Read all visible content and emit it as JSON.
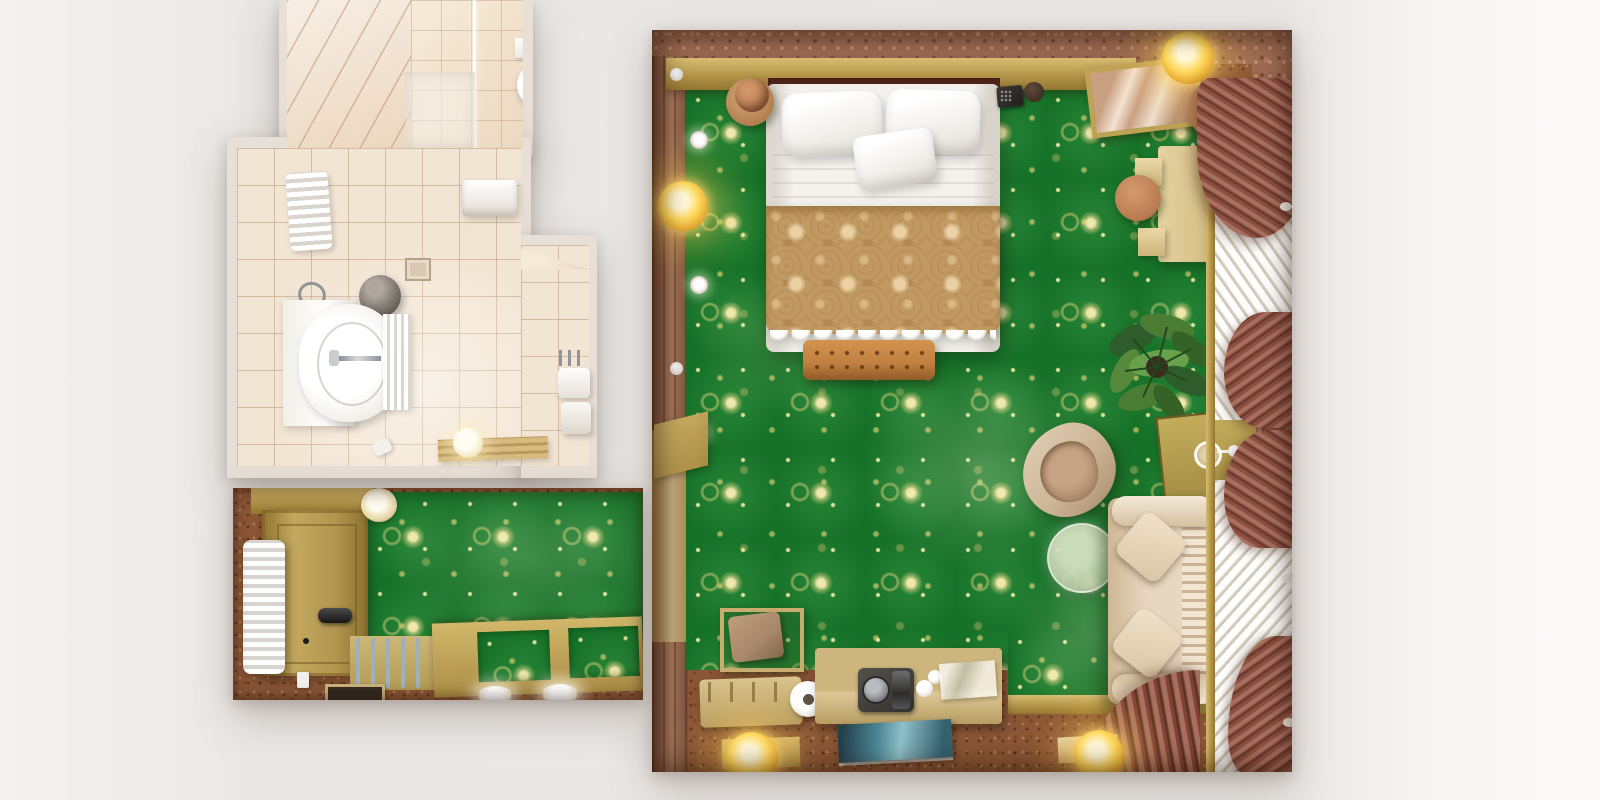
{
  "scene": {
    "type": "top-down 3d architectural render",
    "description": "Overhead render of a hotel suite: en-suite bathroom top-left, entry hallway bottom-left, and a large bedroom on the right with green-and-gold damask carpet, double bed, sofa, desk, plant and curtained windows."
  },
  "colors": {
    "background": "#e9e7e5",
    "carpet_green": "#177229",
    "pattern_gold": "#d8cc7a",
    "carpet_brown": "#8a5636",
    "wall_rose": "#9b6a52",
    "wood_wall": "#9c6b50",
    "wood_gold": "#b3954a",
    "bath_wall": "#e7e0d8",
    "bath_tile": "#f3e5d3",
    "bed_white": "#f5f2ee",
    "blanket": "#c19a63",
    "blanket_light": "#dab685",
    "ottoman": "#c07f40",
    "terracotta": "#b97c52",
    "sofa": "#e7d7c0",
    "armchair": "#cdb496",
    "table_glass": "#b9c9a4",
    "curtain": "#a96f5e",
    "sheer": "#f4eee1",
    "glow": "#ffd95e",
    "plant": "#3c7031",
    "desk": "#d8c28c",
    "phone_black": "#22201e",
    "magazine_teal": "#4b8696",
    "radiator_white": "#f2f1ef",
    "vent_blue": "#9fb0bd",
    "mat_dark": "#332a22"
  },
  "rooms": {
    "bathroom": {
      "name": "bathroom",
      "items": [
        "shower",
        "shower-head",
        "glass-partition",
        "towel-radiator",
        "wall-heater",
        "floor-drain",
        "waste-bin",
        "sink-vanity",
        "faucet",
        "hanging-towels",
        "wooden-mat",
        "ball-lamp"
      ]
    },
    "hallway": {
      "name": "entry-hallway",
      "items": [
        "entry-door",
        "door-handle",
        "radiator",
        "ceiling-lamp",
        "floor-vent",
        "slatted-panels",
        "door-mat",
        "recessed-lights",
        "outlet"
      ]
    },
    "bedroom": {
      "name": "bedroom",
      "items": [
        "double-bed",
        "pillows",
        "damask-blanket",
        "ottoman-bench",
        "nightstand-left",
        "nightstand-right",
        "telephone",
        "mirror-console",
        "ceiling-light",
        "floor-lamp",
        "writing-desk",
        "desk-stool",
        "desk-chair",
        "potted-plant",
        "window-console",
        "wine-glass",
        "armchair",
        "coffee-table",
        "sofa",
        "sheer-curtains",
        "drapes",
        "wall-sconces",
        "tulip-wall-lamps",
        "luggage-rack",
        "minibar-console",
        "coffee-tray",
        "magazine",
        "door-threshold"
      ]
    }
  }
}
